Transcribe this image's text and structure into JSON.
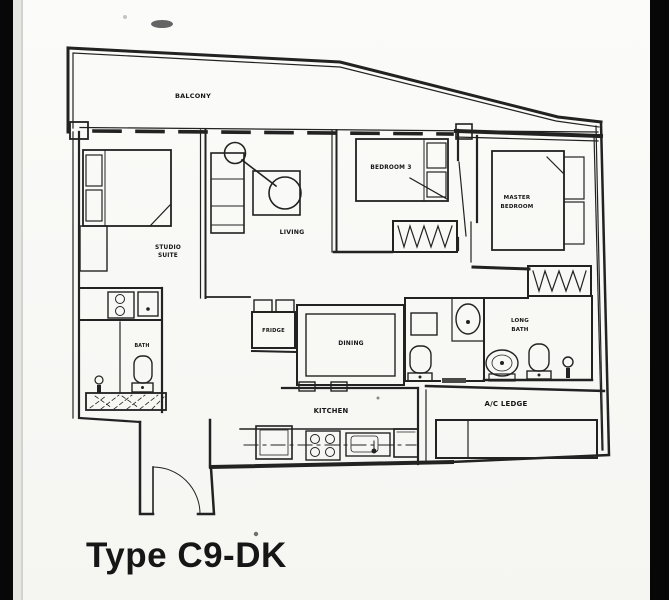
{
  "title": "Type C9-DK",
  "plan": {
    "balcony": "BALCONY",
    "studio_suite": [
      "STUDIO",
      "SUITE"
    ],
    "living": "LIVING",
    "bedroom3": "BEDROOM 3",
    "master_bedroom": [
      "MASTER",
      "BEDROOM"
    ],
    "bath": "BATH",
    "fridge": "FRIDGE",
    "dining": "DINING",
    "long_bath": [
      "LONG",
      "BATH"
    ],
    "kitchen": "KITCHEN",
    "ac_ledge": "A/C LEDGE"
  },
  "colors": {
    "line": "#222220",
    "frame_bars": "#070707",
    "background": "#fbfbf9"
  }
}
